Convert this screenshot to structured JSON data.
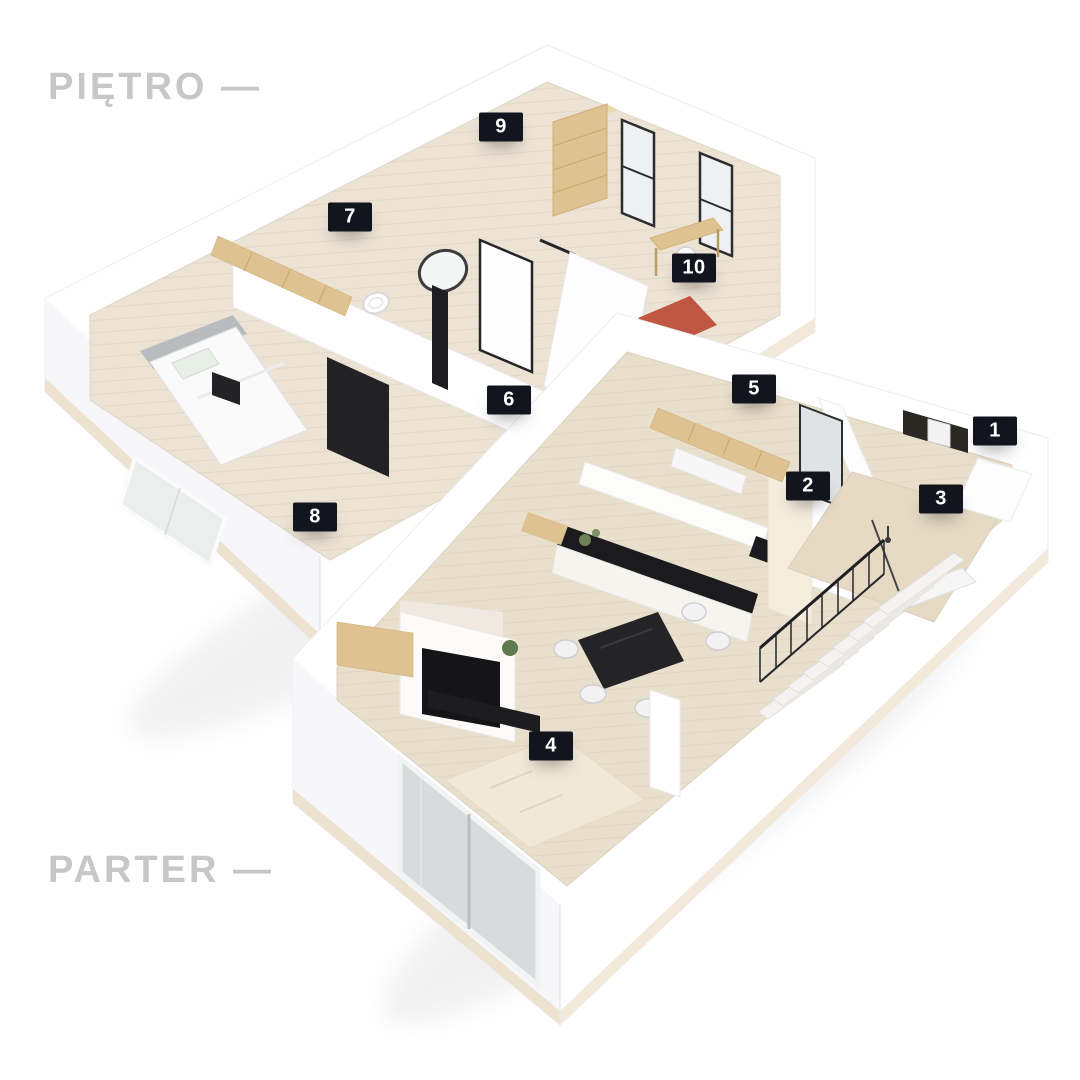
{
  "floors": [
    {
      "id": "pietro",
      "label": "PIĘTRO —"
    },
    {
      "id": "parter",
      "label": "PARTER —"
    }
  ],
  "markers": [
    {
      "number": "1",
      "x": 995,
      "y": 431
    },
    {
      "number": "2",
      "x": 808,
      "y": 486
    },
    {
      "number": "3",
      "x": 941,
      "y": 499
    },
    {
      "number": "4",
      "x": 551,
      "y": 746
    },
    {
      "number": "5",
      "x": 754,
      "y": 389
    },
    {
      "number": "6",
      "x": 509,
      "y": 400
    },
    {
      "number": "7",
      "x": 350,
      "y": 217
    },
    {
      "number": "8",
      "x": 315,
      "y": 517
    },
    {
      "number": "9",
      "x": 501,
      "y": 127
    },
    {
      "number": "10",
      "x": 694,
      "y": 268
    }
  ],
  "colors": {
    "label_text": "#c7c7c9",
    "badge_bg": "#12151d",
    "badge_text": "#ffffff",
    "wall_white": "#ffffff",
    "floor_upper": "#ece3d5",
    "floor_lower": "#e9dfcd",
    "wood": "#dfc291",
    "dark_furniture": "#1d1d1f",
    "rug_red": "#c05743",
    "rug_cream": "#f1e9d8",
    "glass": "#d7dbdc"
  }
}
